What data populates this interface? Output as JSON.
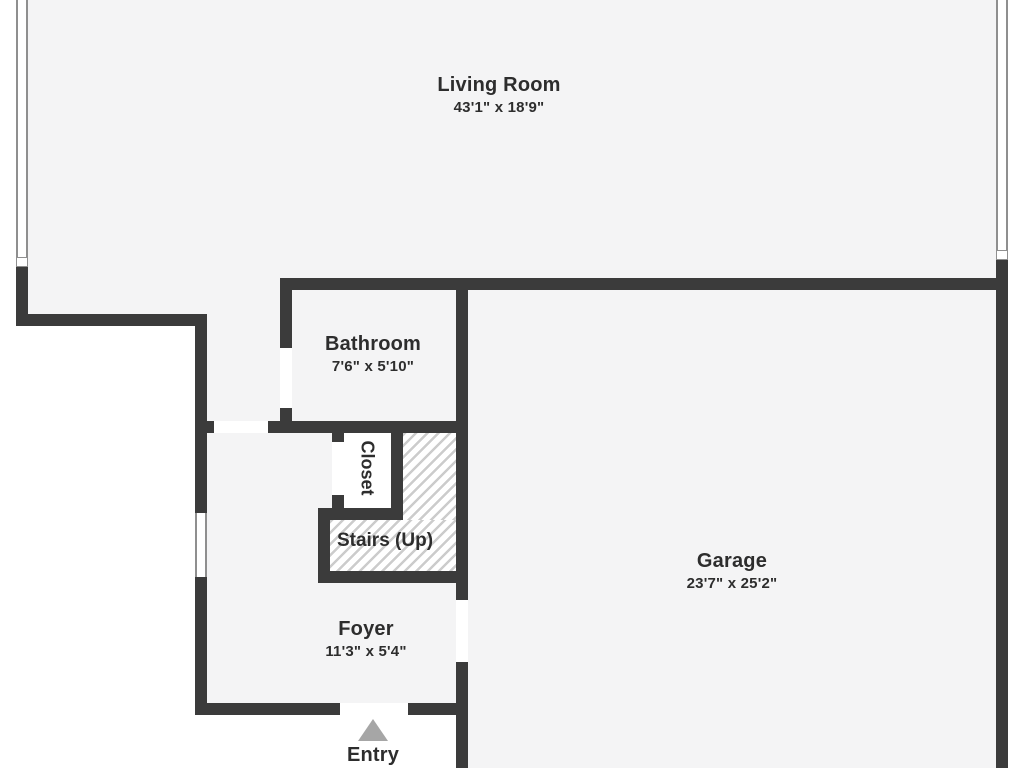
{
  "colors": {
    "background": "#ffffff",
    "room_fill": "#f4f4f5",
    "wall": "#3b3b3b",
    "window_line": "#8f8f8f",
    "hatch_line": "#cccccc",
    "entry_arrow": "#a6a6a6",
    "label_text": "#2d2d2d"
  },
  "rooms": {
    "living_room": {
      "label": "Living Room",
      "dims": "43'1\" x 18'9\""
    },
    "bathroom": {
      "label": "Bathroom",
      "dims": "7'6\" x 5'10\""
    },
    "closet": {
      "label": "Closet"
    },
    "stairs": {
      "label": "Stairs (Up)"
    },
    "garage": {
      "label": "Garage",
      "dims": "23'7\" x 25'2\""
    },
    "foyer": {
      "label": "Foyer",
      "dims": "11'3\" x 5'4\""
    },
    "entry": {
      "label": "Entry"
    }
  }
}
